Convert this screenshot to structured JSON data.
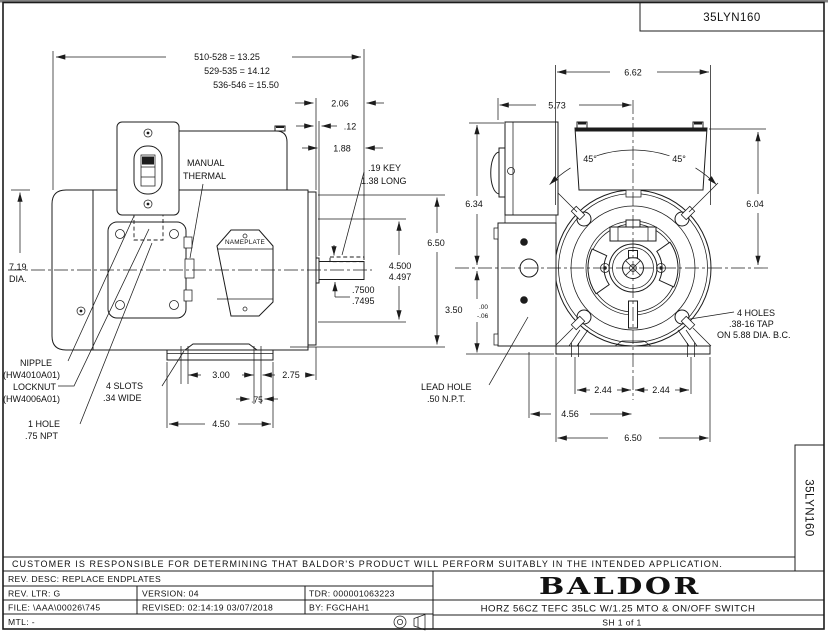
{
  "header": {
    "dwg_no": "35LYN160"
  },
  "strip": {
    "dwg_no": "35LYN160"
  },
  "lv": {
    "len1": "510-528 = 13.25",
    "len2": "529-535 = 14.12",
    "len3": "536-546 = 15.50",
    "d206": "2.06",
    "d012": ".12",
    "d188": "1.88",
    "key1": ".19 KEY",
    "key2": "1.38 LONG",
    "d650": "6.50",
    "d4500": "4.500",
    "d4497": "4.497",
    "d7500": ".7500",
    "d7495": ".7495",
    "dia1": "7.19",
    "dia2": "DIA.",
    "manual1": "MANUAL",
    "manual2": "THERMAL",
    "nameplate": "NAMEPLATE",
    "nip1": "NIPPLE",
    "nip2": "(HW4010A01)",
    "lock1": "LOCKNUT",
    "lock2": "(HW4006A01)",
    "hole1": "1 HOLE",
    "hole2": ".75 NPT",
    "slots1": "4 SLOTS",
    "slots2": ".34 WIDE",
    "d300": "3.00",
    "d275": "2.75",
    "d075": ".75",
    "d450": "4.50"
  },
  "fv": {
    "d662": "6.62",
    "d573": "5.73",
    "a45l": "45°",
    "a45r": "45°",
    "d634": "6.34",
    "d604": "6.04",
    "d350": "3.50",
    "tol_top": ".00",
    "tol_bot": "-.06",
    "holes1": "4 HOLES",
    "holes2": ".38-16 TAP",
    "holes3": "ON 5.88 DIA. B.C.",
    "lead1": "LEAD HOLE",
    "lead2": ".50 N.P.T.",
    "d244a": "2.44",
    "d244b": "2.44",
    "d456": "4.56",
    "d650": "6.50"
  },
  "tb": {
    "note": "CUSTOMER IS RESPONSIBLE FOR DETERMINING THAT BALDOR'S PRODUCT WILL PERFORM SUITABLY IN THE INTENDED APPLICATION.",
    "rev_desc": "REV. DESC:  REPLACE ENDPLATES",
    "rev_ltr": "REV. LTR:  G",
    "version": "VERSION: 04",
    "tdr": "TDR: 000001063223",
    "file": "FILE: \\AAA\\00026\\745",
    "revised": "REVISED: 02:14:19 03/07/2018",
    "by": "BY: FGCHAH1",
    "mtl": "MTL: -",
    "brand": "BALDOR",
    "title": "HORZ 56CZ TEFC 35LC W/1.25 MTO & ON/OFF SWITCH",
    "sheet": "SH 1 of 1"
  }
}
